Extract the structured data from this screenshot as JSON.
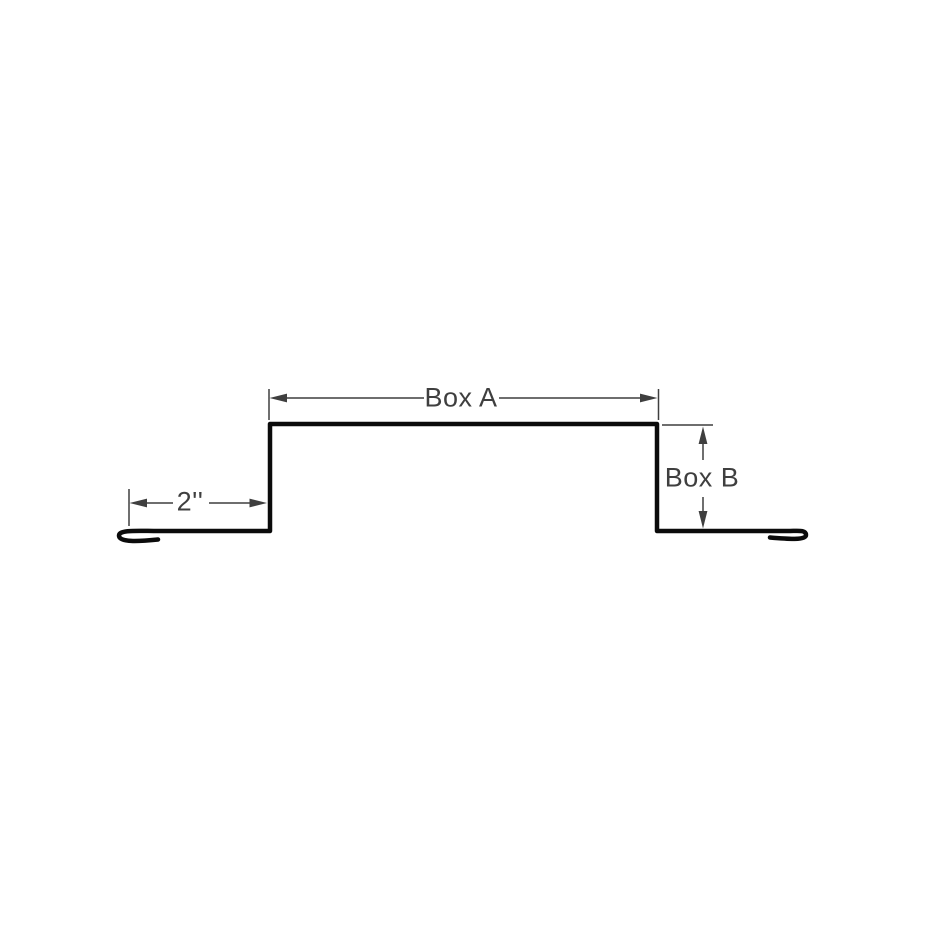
{
  "diagram": {
    "labels": {
      "box_a": "Box A",
      "box_b": "Box B",
      "flange_width": "2''"
    },
    "colors": {
      "background": "#ffffff",
      "profile_line": "#0b0b0b",
      "dimension": "#3f3f3f",
      "label_text": "#3f3f3f"
    }
  }
}
